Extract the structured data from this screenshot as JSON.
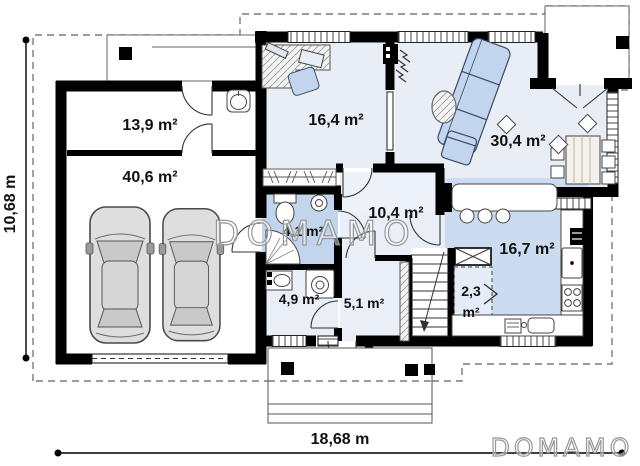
{
  "rooms": {
    "storage": "13,9 m²",
    "garage": "40,6 m²",
    "office": "16,4 m²",
    "living": "30,4 m²",
    "bathroom": "4,1 m²",
    "hall": "10,4 m²",
    "kitchen": "16,7 m²",
    "laundry": "4,9 m²",
    "entry": "5,1 m²",
    "pantry_line1": "2,3",
    "pantry_line2": "m²"
  },
  "dimensions": {
    "height": "10,68 m",
    "width": "18,68 m"
  },
  "watermarks": {
    "center": "DOMAMO",
    "corner": "DOMAMO"
  },
  "colors": {
    "wall": "#000000",
    "floor_tint": "#e9edf6",
    "floor_hall": "#edf1f8",
    "floor_kitchen": "#cbdcf0",
    "floor_bath": "#c2d5ec",
    "furniture_blue": "#c3d4ee",
    "dashed_outline": "#7a7a7a",
    "watermark": "#979797"
  }
}
